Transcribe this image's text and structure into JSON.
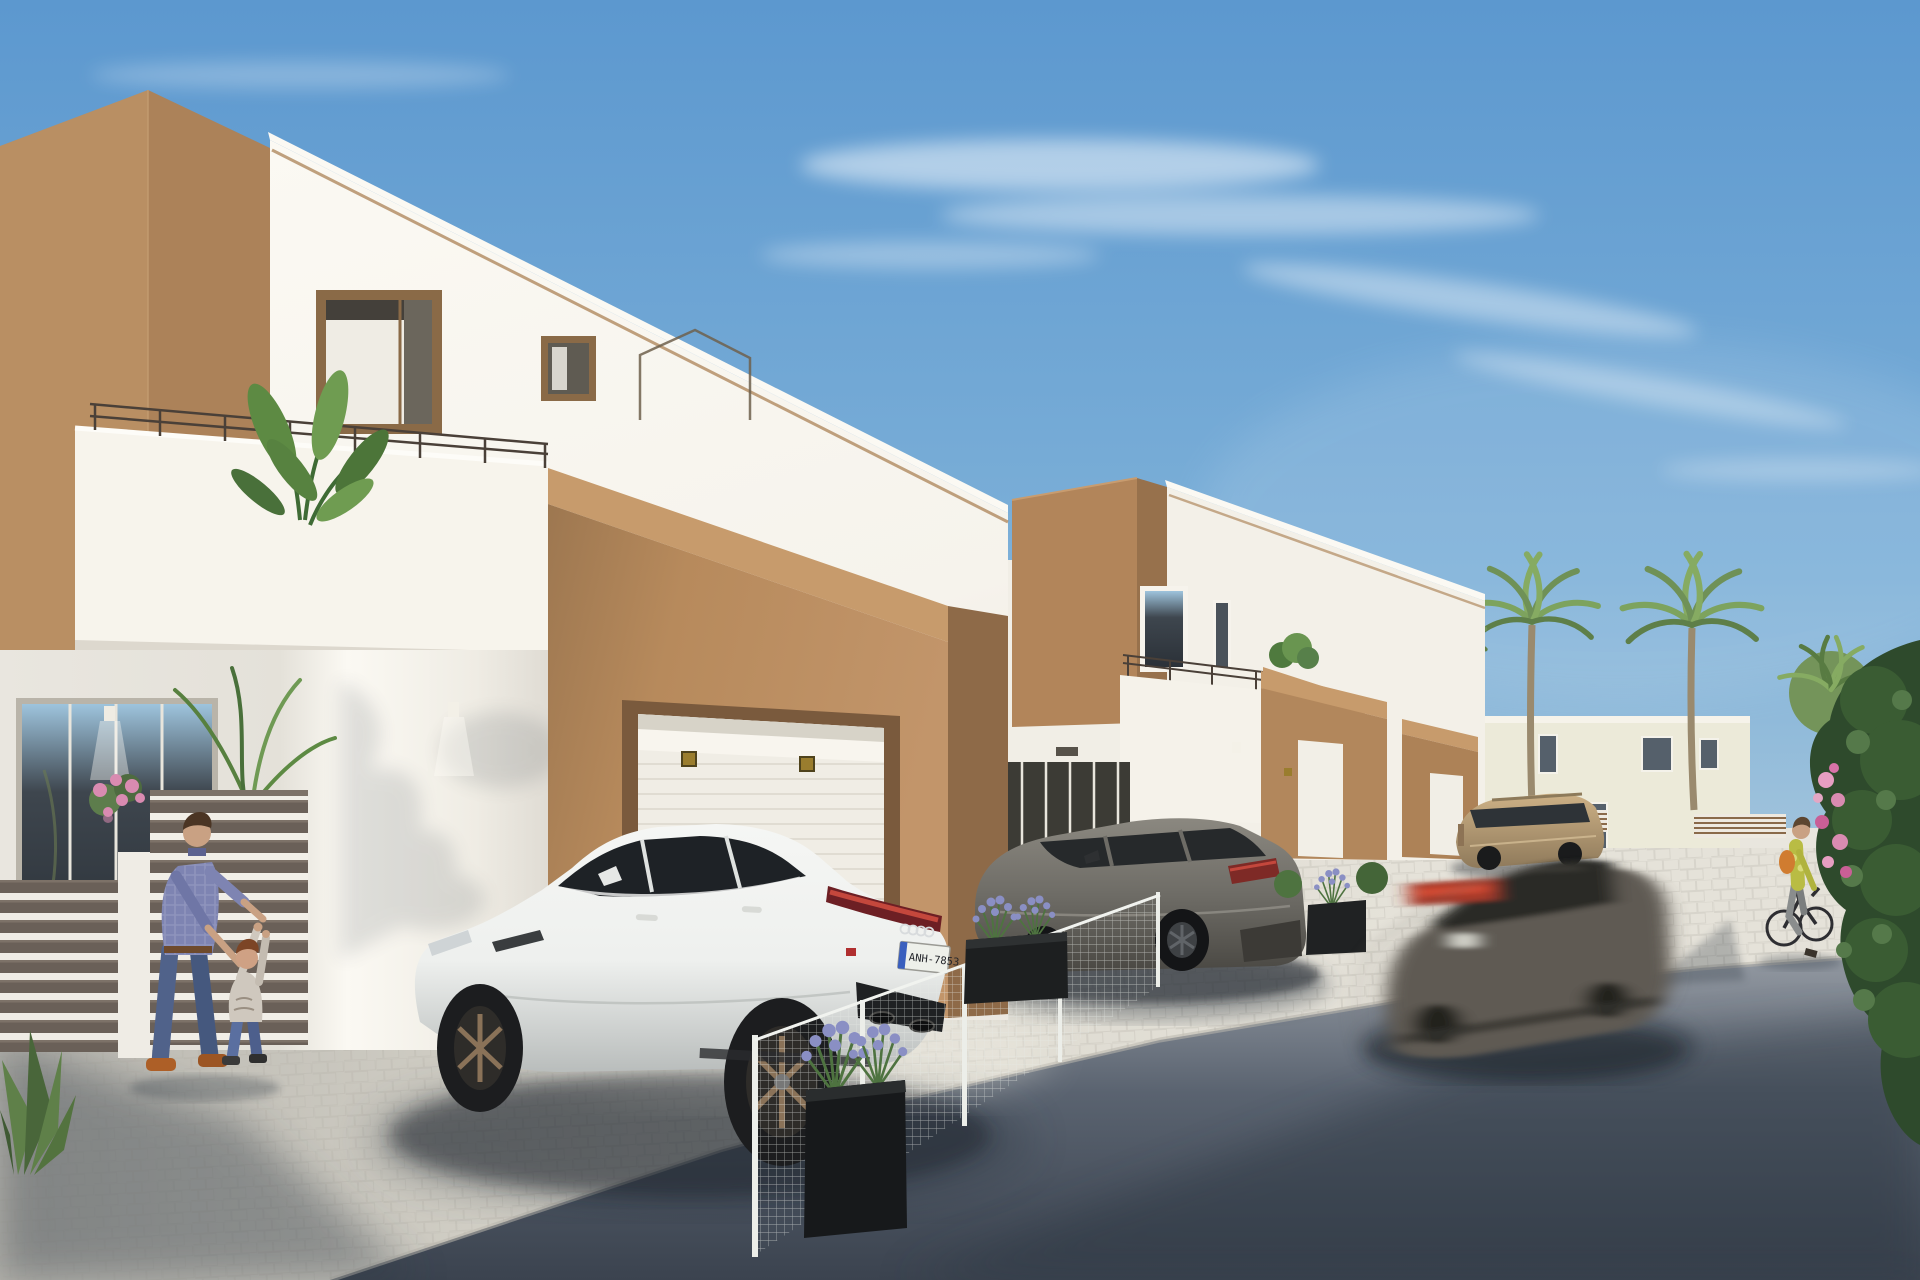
{
  "scene": {
    "title": "Modern Mediterranean townhouse street render",
    "type": "photorealistic architectural 3D visualization",
    "setting": "new-build two-storey white and tan stucco townhouses along a street",
    "time_of_day": "sunny daytime, clear blue sky with thin clouds",
    "camera": "street-level view looking down the row of houses receding to the right"
  },
  "palette": {
    "sky_top": "#5c98cf",
    "sky_mid": "#7db0d8",
    "sky_low": "#b5cede",
    "sky_horizon": "#d3dde2",
    "white_sunlit": "#f6f3ec",
    "white_bright": "#fbf9f3",
    "white_shaded": "#e4e1d9",
    "tan_front": "#ac8259",
    "tan_side": "#b98f63",
    "tan_porch": "#b78a5c",
    "tan_dark": "#8e6a48",
    "tan_cap": "#c79b6c",
    "frame_brown": "#8a6a47",
    "glass_dark": "#3e464e",
    "road_far": "#9aa0a8",
    "road_mid": "#5a6370",
    "road_near": "#3b434f",
    "paver_light": "#e5e2d9",
    "paver_mid": "#d8d5cb",
    "paver_shade": "#b8b6af",
    "paver_line": "#b3afa5",
    "fence_slat": "#6a6058",
    "foliage_dark": "#2e4a2c",
    "foliage_mid": "#4e7340",
    "foliage_light": "#6f9a54",
    "palm_green": "#7da35e",
    "lavender": "#8a8fc4",
    "pink_flower": "#d98bb1",
    "car_white": "#eef0ee",
    "car_gray": "#6e6c66",
    "car_blur": "#5f5a52",
    "car_beige": "#b59a76",
    "wheel_bronze": "#8a7258",
    "tail_red": "#c4473c",
    "lamp_gold": "#9a7d2e",
    "shadow_tint": "#2c3440",
    "skin": "#c9a183",
    "shirt_plaid": "#7e84b2",
    "jeans": "#50628a",
    "shoe_orange": "#ad5f27",
    "cyclist_top": "#b9bc44",
    "bag_orange": "#d07c30"
  },
  "buildings": {
    "house_1": {
      "label": "foreground townhouse",
      "features": [
        "tan corner volume",
        "white upper facade",
        "roof-terrace railing",
        "banana plant on terrace",
        "framed window with curtain",
        "wire house-outline wall art",
        "tan garage porch with white roller door",
        "two gold porch lights",
        "ground-floor glass slider",
        "wall downlights"
      ]
    },
    "house_2": {
      "label": "middle townhouse",
      "features": [
        "tan cube volume",
        "white wing with two windows",
        "terrace with railing and plant",
        "tan-capped parapet",
        "glazed ground floor",
        "tan entry porch with white door"
      ]
    },
    "house_3": {
      "label": "far townhouse",
      "features": [
        "tan entry porch",
        "white door",
        "white side walls"
      ]
    },
    "background": {
      "label": "distant white houses",
      "features": [
        "flat-roof white building with small dark windows",
        "low white walls",
        "horizontal wood-slat fence panels"
      ]
    }
  },
  "vehicles": {
    "white_car": {
      "label": "white sportback sedan parked on driveway",
      "plate": "ANH-7853",
      "details": [
        "red LED tail-light strip",
        "bronze five-spoke wheels",
        "dark diffuser with exhausts"
      ]
    },
    "gray_suv": {
      "label": "gunmetal gray SUV parked at middle house",
      "details": [
        "dark wheels",
        "red tail lamp",
        "white plate"
      ]
    },
    "blur_car": {
      "label": "dark sedan driving by with motion blur",
      "details": [
        "red tail-light smear"
      ]
    },
    "beige_suv": {
      "label": "beige compact SUV parked in background"
    }
  },
  "people": {
    "man": {
      "label": "man in plaid shirt and jeans playing with toddler",
      "shoes": "orange"
    },
    "child": {
      "label": "toddler in print tee and jeans reaching up"
    },
    "cyclist": {
      "label": "woman cycling on the street",
      "top": "yellow-green floral",
      "bag": "orange"
    }
  },
  "vegetation": {
    "palms": "four tall palm trees plus one round bushy palm behind the far houses",
    "terrace_plant": "banana / strelitzia plant on house 1 terrace",
    "planters": "black box planters with lavender along driveways",
    "bush": "large dark green shrub with pink bougainvillea at right edge",
    "agave": "spiky agave at lower-left corner"
  },
  "ground": {
    "pavers": "light cobble paver sidewalk and driveways",
    "road": "dark asphalt street with long soft shadows"
  }
}
